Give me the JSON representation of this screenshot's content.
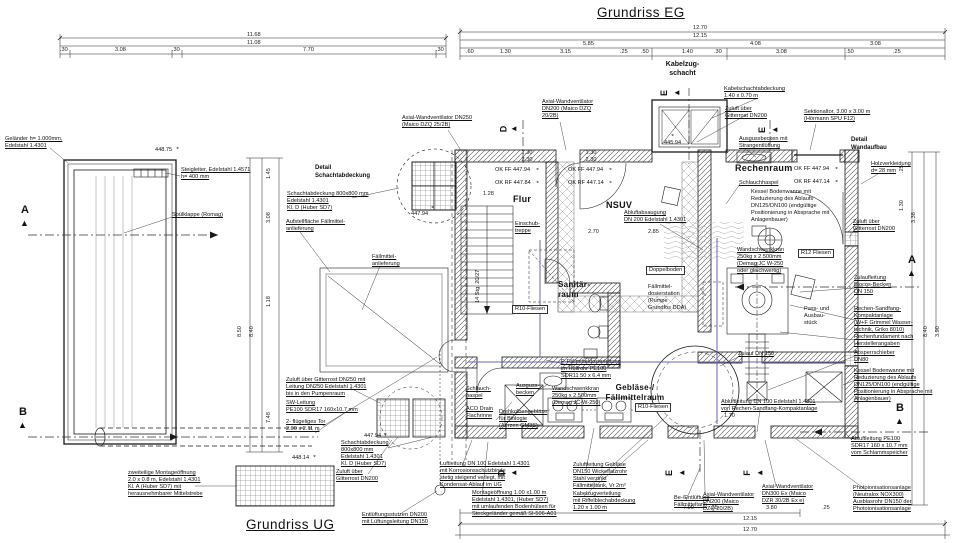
{
  "colors": {
    "paper": "#ffffff",
    "ink": "#1a1a1a",
    "pipe_accent": "#6a66bb",
    "hatch": "#555555"
  },
  "titles": {
    "eg": "Grundriss EG",
    "ug": "Grundriss UG"
  },
  "rooms": {
    "flur": "Flur",
    "nsuv": "NSUV",
    "rechenraum": "Rechenraum",
    "sanitaerraum": "Sanitär-\nraum",
    "geblaeseraum": "Gebläse-/\nFällmittelraum"
  },
  "markers": {
    "a": "A",
    "b": "B",
    "d": "D",
    "e": "E",
    "f": "F"
  },
  "glyphs": {
    "tri_up": "▲",
    "tri_left": "◄",
    "tri_right": "►",
    "level": "◒"
  },
  "levels": {
    "l44875": "448.75",
    "l44814": "448.14",
    "l44794": "447.94",
    "l44594": "445.94",
    "flur_ff": "OK FF 447.94",
    "flur_rf": "OK RF 447.84",
    "nsuv_ff": "OK FF 447.94",
    "nsuv_rf": "OK RF 447.14",
    "re_ff": "OK FF 447.94",
    "re_rf": "OK RF 447.14"
  },
  "labels": {
    "gelaender": "Geländer h= 1.000mm,\nEdelstahl 1.4301",
    "steigleiter": "Steigleiter, Edelstahl 1.4571\nh= 400 mm",
    "spuelklappe": "Spülklappe (Romag)",
    "montage_ug": "zweiteilige Montageöffnung\n2.0 x 0.8 m, Edelstahl 1.4301\nKl. A (Huber SD7) mit\nherausnehmbarer Mittelstrebe",
    "zuluft250": "Zuluft über Gitterrost DN250 mit\nLeitung DN250 Edelstahl 1.4301\nbis in den Pumpenraum",
    "sw_leitung": "SW-Leitung\nPE100 SDR17 160x10.7 mm",
    "tor": "2- flügeliges Tor\n2.00 x 2.11 m",
    "schacht2": "Schachtabdeckung\n800x800 mm\nEdelstahl 1.4301\nKl. D (Huber SD7)",
    "zuluft200ug": "Zuluft über\nGitterrost DN200",
    "entlueftung": "Entlüftungsstutzen DN200\nmit Lüftungsleitung DN150",
    "det_schacht_title": "Detail\nSchachtabdeckung",
    "det_schacht_text": "Schachtabdeckung 800x800 mm\nEdelstahl 1.4301\nKl. D (Huber SD7)",
    "aufstell": "Aufstellfläche Fällmittel-\nanlieferung",
    "faellmittel_anl": "Fällmittel-\nanlieferung",
    "vent250": "Axial-Wandventilator DN250\n(Maico DZQ 25/2B)",
    "vent200top": "Axial-Wandventilator\nDN200 (Maico DZQ\n20/2B)",
    "kabelzugschacht": "Kabelzug-\nschacht",
    "kabelabdeckung": "Kabelschachtabdeckung\n1.40 x 0.70 m",
    "zuluft_top": "Zuluft über\nGitterrost DN200",
    "ausgussbecken_top": "Ausgussbecken mit\nStrangentlüftung",
    "sektionaltor": "Sektionaltor, 3.00 x 3.00 m\n(Hörmann SPU F12)",
    "det_wand_title": "Detail\nWandaufbau",
    "holzverkleidung": "Holzverkleidung\nd= 28 mm",
    "einschubtreppe": "Einschub-\ntreppe",
    "abluftabsaugung": "Abluftabsaugung\nDN 200 Edelstahl 1.4301",
    "schlauchhaspel_re": "Schlauchhaspel",
    "kessel_re": "Kessel Bodenwanne mit\nReduzierung des Ablaufs\nDN125/DN100 (endgültige\nPositionierung in Absprache mit\nAnlagenbauer)",
    "kran_re": "Wandschwenkkran\n250kg x 2.500mm\n(Demag JC W-250\noder gleichwertig)",
    "r12": "R12 Fliesen",
    "zuluft_right": "Zuluft über\nGitterrost DN200",
    "zulaufleitung": "Zulaufleitung\nBiocos-Becken\nDN 150",
    "rechenanlage": "Rechen-Sandfang-\nKompaktanlage\n(W+F Grimmel Wasser-\ntechnik, Griko 8010)",
    "fundament": "Rechenfundament nach\nHerstellerangaben",
    "absperr": "Absperrschieber\nDN80",
    "kessel_r2": "Kessel Bodenwanne mit\nReduzierung des Ablaufs\nDN125/DN100 (endgültige\nPositionierung in Absprache mit\nAnlagenbauer)",
    "pass": "Pass- und\nAusbau-\nstück",
    "zulauf150": "Zulauf DN 150",
    "abluft_rechen": "Abluftleitung DN 100 Edelstahl 1.4301\nvon Rechen-Sandfang-Kompaktanlage",
    "abluft_pe": "Abluftleitung PE100\nSDR17 160 x 10.7 mm\nvom Schlammspeicher",
    "photoion": "Photoionisationsanlage\n(Neutralox NOX300)\nAusblasrohr DN150 der\nPhotoionisationsanlage",
    "vent300": "Axial-Wandventilator\nDN300 Ex (Maico\nDZR 30/2B Ex e)",
    "vent200b": "Axial-Wandventilator\nDN200 (Maico\nDZQ 20/2B)",
    "doppelboden": "Doppelboden",
    "dosierstation": "Fällmittel-\ndosierstation\n(Pumpe\nGrundfos DDA)",
    "r10a": "R10-Fliesen",
    "r10b": "R10-Fliesen",
    "p_leitung": "P-Fällmitteldosierleitung\nim Hüllrohr PE100\nSDR11 50 x 6.4 mm",
    "schlauch_geb": "Schlauch-\nhaspel",
    "aco": "ACO Drain\nFlachrinne",
    "ausguss_geb": "Ausguss-\nbecken",
    "drehkolben": "Drehkolbengebläse\nfür Biologie\n(Aerzen GM3S)",
    "kran_geb": "Wandschwenkkran\n250kg x 2.500mm\n(Demag JC-W-250)",
    "faelltank": "Fällmitteltank, Vr 2m³",
    "luftleitung": "Luftleitung DN 100 Edelstahl 1.4301\nmit Korrosionsschutzbinde\nstetig steigend verlegt, mit\nKondensat-Ablauf im UG",
    "montage_eg": "Montageöffnung 1.00 x1.00 m\nEdelstahl 1.4301, (Huber SD7)\nmit umlaufenden Bodenhülsen für\nSteckgeländer gemäß SI-506-A01",
    "zuluft_geb": "Zuluftleitung Gebläse\nDN150 Wickelfalzrohr\nStahl verzinkt",
    "kabelvert": "Kabelzugverteilung\nmit Riffelblechabdeckung\n1.20 x 1.00 m",
    "be_ent": "Be-/Entlüftung\nFällmitteltank"
  },
  "dims": {
    "d1168": "11.68",
    "d1108": "11.08",
    "d030": ".30",
    "d308": "3.08",
    "d770": "7.70",
    "d1270": "12.70",
    "d1215": "12.15",
    "d585": "5.85",
    "d408": "4.08",
    "d060": ".60",
    "d130": "1.30",
    "d315": "3.15",
    "d025": ".25",
    "d050": ".50",
    "d140": "1.40",
    "d790": "7.90",
    "d380": "3.80",
    "d850": "8.50",
    "d840": "8.40",
    "d118": "1.18",
    "d748": "7.48",
    "d145": "1.45",
    "d338": "3.38",
    "d390": "3.90",
    "door": "1.30\n2.30",
    "d270": "2.70",
    "d285": "2.85",
    "d128": "1.28",
    "d170": "1.70",
    "stairs": "14 Stg. 20/27"
  }
}
